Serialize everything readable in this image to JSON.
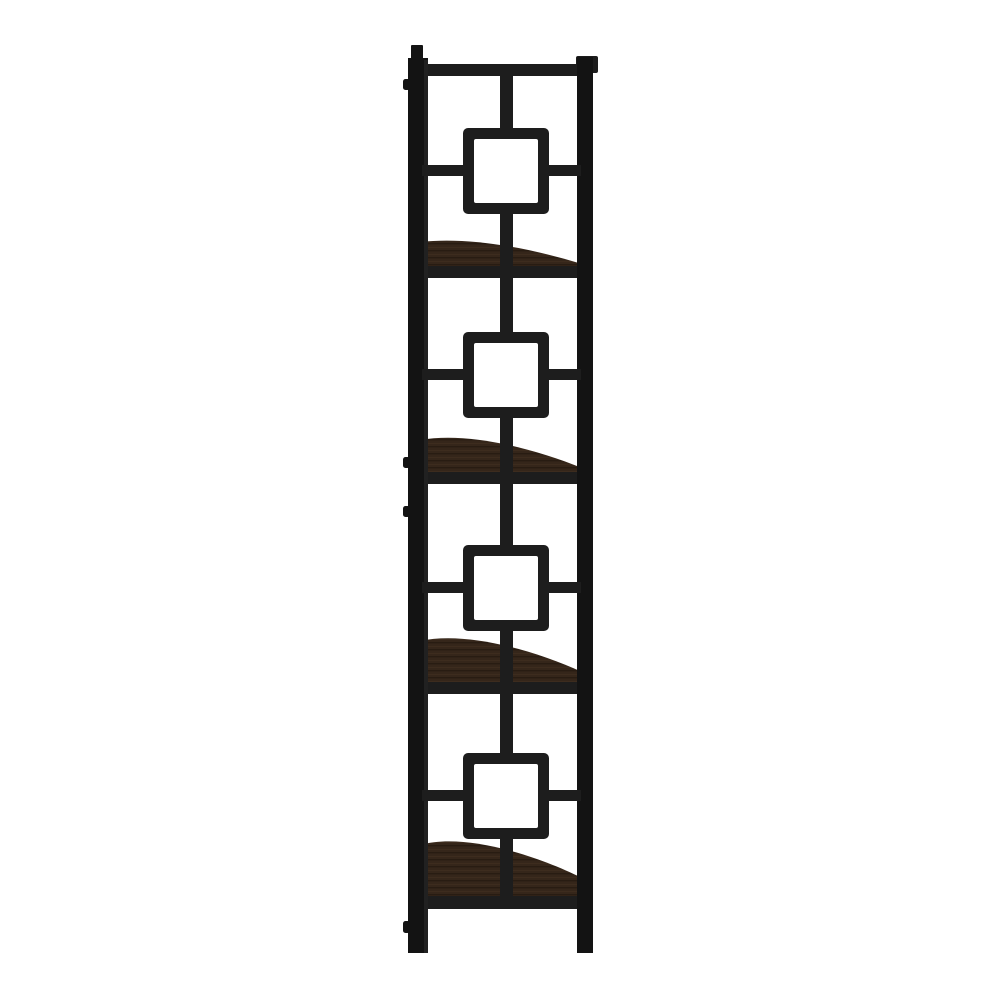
{
  "image": {
    "kind": "product-photo",
    "description": "Side profile view of a tall black metal corner etagere bookcase with square fretwork lattice frame and four dark espresso quarter-round wood shelves on a plain white background",
    "shelf_count": 4,
    "background_style": "plain white studio background"
  },
  "colors": {
    "background": "#ffffff",
    "metal": "#1d1d1d",
    "metal_deep": "#131313",
    "metal_highlight": "#2e2e2e",
    "wood_base": "#35261a",
    "wood_grain_dark": "#261a10",
    "wood_grain_light": "#453221"
  }
}
